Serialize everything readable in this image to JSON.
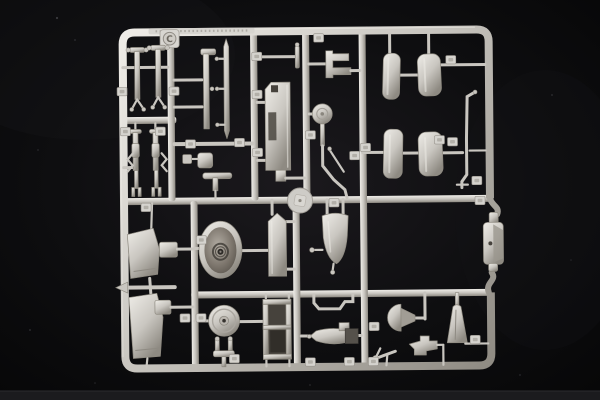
{
  "scene": {
    "description": "Photograph of a light-grey injection-moulded model aircraft kit sprue on a black cloth backdrop",
    "sprue_letter": "C"
  },
  "sprue": {
    "letter": "C"
  },
  "colors": {
    "background": "#070708",
    "backdrop_glow": "#1b191d",
    "floor_strip": "#1b1b1e",
    "plastic_highlight": "#efede8",
    "plastic_base": "#c9c6c0",
    "plastic_shadow": "#8e8a82",
    "plastic_deep": "#6b675f",
    "tag_face": "#d5d3ce",
    "dome_light": "#b2aca3",
    "dome_mid": "#7d766d",
    "dome_dark": "#4f4a43",
    "dark_slot": "#46423c"
  }
}
